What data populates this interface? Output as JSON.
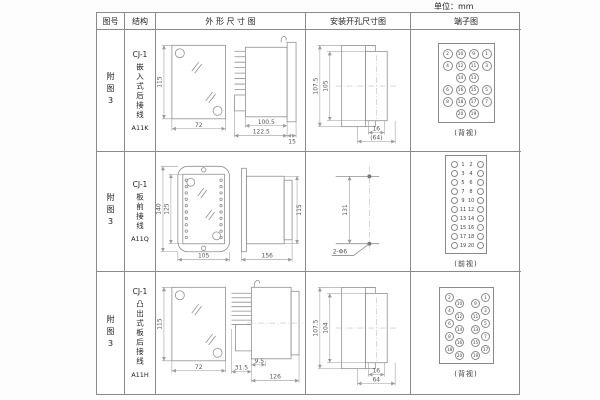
{
  "unit_label": "单位：mm",
  "header": {
    "figure": "图号",
    "structure": "结构",
    "outline": "外 形 尺 寸 图",
    "install": "安装开孔尺寸图",
    "terminal": "端子图"
  },
  "rows": [
    {
      "figure": "附图3",
      "structure": {
        "model": "CJ-1",
        "type": "嵌入式后接线",
        "code": "A11K"
      },
      "outline": {
        "front_h": "115",
        "front_w": "72",
        "body_l": "100.5",
        "total_l": "122.5",
        "flange_w": "15"
      },
      "install": {
        "outer_h": "107.5",
        "inner_h": "105",
        "slot_w": "16",
        "total_w": "(64)"
      },
      "terminal": {
        "view": "(背视)",
        "w": 57,
        "h": 80,
        "r": 5,
        "f": 4.5,
        "items": [
          {
            "n": "2",
            "x": 9,
            "y": 10
          },
          {
            "n": "10",
            "x": 22,
            "y": 10
          },
          {
            "n": "9",
            "x": 35,
            "y": 10
          },
          {
            "n": "1",
            "x": 48,
            "y": 10
          },
          {
            "n": "4",
            "x": 9,
            "y": 22
          },
          {
            "n": "12",
            "x": 22,
            "y": 22
          },
          {
            "n": "11",
            "x": 35,
            "y": 22
          },
          {
            "n": "3",
            "x": 48,
            "y": 22
          },
          {
            "n": "14",
            "x": 22,
            "y": 34
          },
          {
            "n": "13",
            "x": 35,
            "y": 34
          },
          {
            "n": "6",
            "x": 9,
            "y": 46
          },
          {
            "n": "16",
            "x": 22,
            "y": 46
          },
          {
            "n": "15",
            "x": 35,
            "y": 46
          },
          {
            "n": "5",
            "x": 48,
            "y": 46
          },
          {
            "n": "8",
            "x": 9,
            "y": 58
          },
          {
            "n": "18",
            "x": 22,
            "y": 58
          },
          {
            "n": "17",
            "x": 35,
            "y": 58
          },
          {
            "n": "7",
            "x": 48,
            "y": 58
          },
          {
            "n": "20",
            "x": 22,
            "y": 70
          },
          {
            "n": "19",
            "x": 35,
            "y": 70
          }
        ]
      }
    },
    {
      "figure": "附图3",
      "structure": {
        "model": "CJ-1",
        "type": "板前接线",
        "code": "A11Q"
      },
      "outline": {
        "outer_h": "140",
        "inner_h": "125",
        "front_w": "105",
        "side_l": "156",
        "side_h": "115"
      },
      "install": {
        "dist": "131",
        "holes": "2-Φ6"
      },
      "terminal": {
        "view": "(前视)",
        "w": 42,
        "h": 99,
        "r": 3.5,
        "f": 5,
        "items": [
          {
            "n": "",
            "x": 8,
            "y": 9
          },
          {
            "n": "1",
            "x": 17,
            "y": 9,
            "t": 1
          },
          {
            "n": "2",
            "x": 25,
            "y": 9,
            "t": 1
          },
          {
            "n": "",
            "x": 34,
            "y": 9
          },
          {
            "n": "",
            "x": 8,
            "y": 18
          },
          {
            "n": "3",
            "x": 17,
            "y": 18,
            "t": 1
          },
          {
            "n": "4",
            "x": 25,
            "y": 18,
            "t": 1
          },
          {
            "n": "",
            "x": 34,
            "y": 18
          },
          {
            "n": "",
            "x": 8,
            "y": 27
          },
          {
            "n": "5",
            "x": 17,
            "y": 27,
            "t": 1
          },
          {
            "n": "6",
            "x": 25,
            "y": 27,
            "t": 1
          },
          {
            "n": "",
            "x": 34,
            "y": 27
          },
          {
            "n": "",
            "x": 8,
            "y": 36
          },
          {
            "n": "7",
            "x": 17,
            "y": 36,
            "t": 1
          },
          {
            "n": "8",
            "x": 25,
            "y": 36,
            "t": 1
          },
          {
            "n": "",
            "x": 34,
            "y": 36
          },
          {
            "n": "",
            "x": 8,
            "y": 45
          },
          {
            "n": "9",
            "x": 17,
            "y": 45,
            "t": 1
          },
          {
            "n": "10",
            "x": 25,
            "y": 45,
            "t": 1
          },
          {
            "n": "",
            "x": 34,
            "y": 45
          },
          {
            "n": "",
            "x": 8,
            "y": 54
          },
          {
            "n": "11",
            "x": 17,
            "y": 54,
            "t": 1
          },
          {
            "n": "12",
            "x": 25,
            "y": 54,
            "t": 1
          },
          {
            "n": "",
            "x": 34,
            "y": 54
          },
          {
            "n": "",
            "x": 8,
            "y": 63
          },
          {
            "n": "13",
            "x": 17,
            "y": 63,
            "t": 1
          },
          {
            "n": "14",
            "x": 25,
            "y": 63,
            "t": 1
          },
          {
            "n": "",
            "x": 34,
            "y": 63
          },
          {
            "n": "",
            "x": 8,
            "y": 72
          },
          {
            "n": "15",
            "x": 17,
            "y": 72,
            "t": 1
          },
          {
            "n": "16",
            "x": 25,
            "y": 72,
            "t": 1
          },
          {
            "n": "",
            "x": 34,
            "y": 72
          },
          {
            "n": "",
            "x": 8,
            "y": 81
          },
          {
            "n": "17",
            "x": 17,
            "y": 81,
            "t": 1
          },
          {
            "n": "18",
            "x": 25,
            "y": 81,
            "t": 1
          },
          {
            "n": "",
            "x": 34,
            "y": 81
          },
          {
            "n": "",
            "x": 8,
            "y": 90
          },
          {
            "n": "19",
            "x": 17,
            "y": 90,
            "t": 1
          },
          {
            "n": "20",
            "x": 25,
            "y": 90,
            "t": 1
          },
          {
            "n": "",
            "x": 34,
            "y": 90
          }
        ]
      }
    },
    {
      "figure": "附图3",
      "structure": {
        "model": "CJ-1",
        "type": "凸出式板后接线",
        "code": "A11H"
      },
      "outline": {
        "front_h": "115",
        "front_w": "72",
        "pin_l": "31.5",
        "gap": "9.5",
        "body_l": "126"
      },
      "install": {
        "outer_h": "107.5",
        "inner_h": "104",
        "slot_w": "16",
        "total_w": "64"
      },
      "terminal": {
        "view": "(背视)",
        "w": 55,
        "h": 77,
        "r": 4.5,
        "f": 4.2,
        "items": [
          {
            "n": "2",
            "x": 10,
            "y": 9
          },
          {
            "n": "10",
            "x": 20,
            "y": 15.5
          },
          {
            "n": "4",
            "x": 10,
            "y": 22
          },
          {
            "n": "12",
            "x": 20,
            "y": 28.5
          },
          {
            "n": "6",
            "x": 10,
            "y": 35
          },
          {
            "n": "14",
            "x": 20,
            "y": 41.5
          },
          {
            "n": "8",
            "x": 10,
            "y": 48
          },
          {
            "n": "16",
            "x": 20,
            "y": 54.5
          },
          {
            "n": "18",
            "x": 10,
            "y": 61
          },
          {
            "n": "20",
            "x": 20,
            "y": 67.5
          },
          {
            "n": "9",
            "x": 36,
            "y": 15.5
          },
          {
            "n": "1",
            "x": 46,
            "y": 9
          },
          {
            "n": "11",
            "x": 36,
            "y": 28.5
          },
          {
            "n": "3",
            "x": 46,
            "y": 22
          },
          {
            "n": "13",
            "x": 36,
            "y": 41.5
          },
          {
            "n": "5",
            "x": 46,
            "y": 35
          },
          {
            "n": "15",
            "x": 36,
            "y": 54.5
          },
          {
            "n": "7",
            "x": 46,
            "y": 48
          },
          {
            "n": "19",
            "x": 36,
            "y": 67.5
          },
          {
            "n": "17",
            "x": 46,
            "y": 61
          }
        ]
      }
    }
  ]
}
